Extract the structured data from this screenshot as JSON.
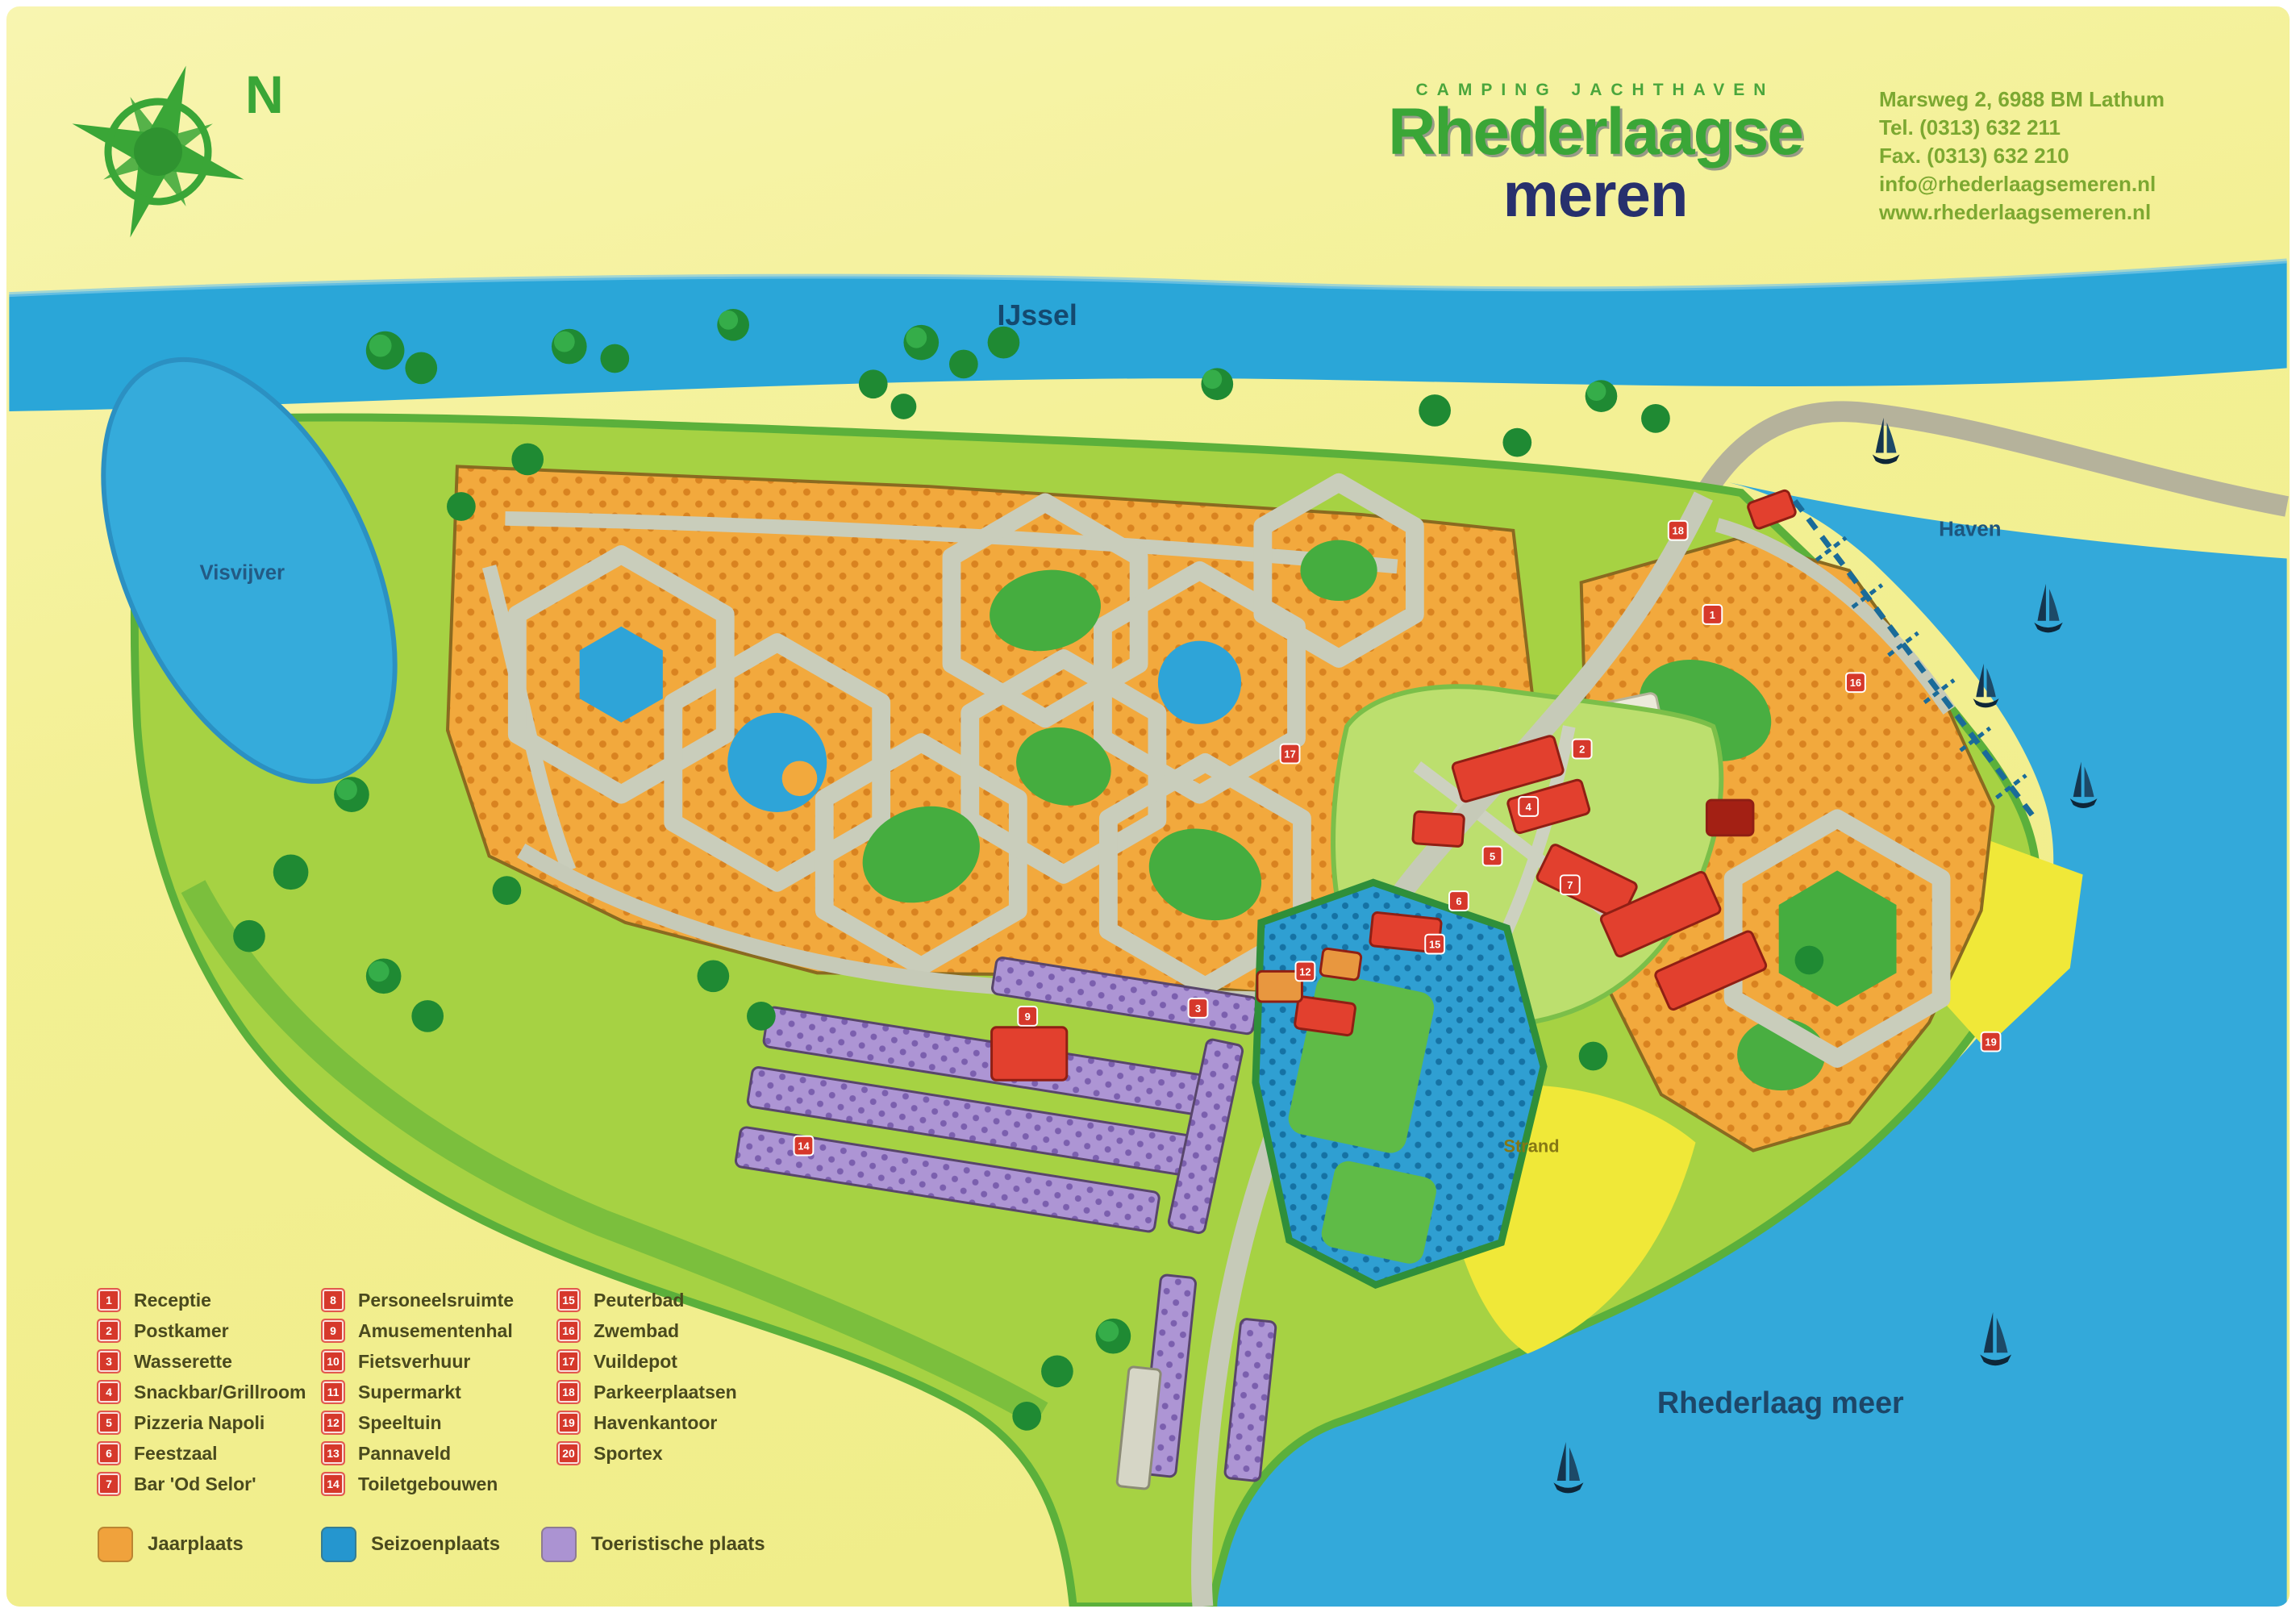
{
  "header": {
    "tagline": "CAMPING JACHTHAVEN",
    "title_line1": "Rhederlaagse",
    "title_line2": "meren",
    "compass_label": "N",
    "contact": {
      "address": "Marsweg 2, 6988 BM Lathum",
      "tel": "Tel.  (0313) 632 211",
      "fax": "Fax. (0313) 632 210",
      "email": "info@rhederlaagsemeren.nl",
      "website": "www.rhederlaagsemeren.nl"
    }
  },
  "map": {
    "labels": {
      "river": "IJssel",
      "pond": "Visvijver",
      "harbor": "Haven",
      "beach": "Strand",
      "lake": "Rhederlaag meer"
    },
    "markers": [
      {
        "num": "18"
      },
      {
        "num": "1"
      },
      {
        "num": "2"
      },
      {
        "num": "4"
      },
      {
        "num": "5"
      },
      {
        "num": "6"
      },
      {
        "num": "7"
      },
      {
        "num": "15"
      },
      {
        "num": "16"
      },
      {
        "num": "17"
      },
      {
        "num": "3"
      },
      {
        "num": "14"
      },
      {
        "num": "9"
      },
      {
        "num": "19"
      },
      {
        "num": "12"
      }
    ]
  },
  "legend": {
    "facilities": [
      {
        "num": "1",
        "label": "Receptie"
      },
      {
        "num": "2",
        "label": "Postkamer"
      },
      {
        "num": "3",
        "label": "Wasserette"
      },
      {
        "num": "4",
        "label": "Snackbar/Grillroom"
      },
      {
        "num": "5",
        "label": "Pizzeria Napoli"
      },
      {
        "num": "6",
        "label": "Feestzaal"
      },
      {
        "num": "7",
        "label": "Bar 'Od Selor'"
      },
      {
        "num": "8",
        "label": "Personeelsruimte"
      },
      {
        "num": "9",
        "label": "Amusementenhal"
      },
      {
        "num": "10",
        "label": "Fietsverhuur"
      },
      {
        "num": "11",
        "label": "Supermarkt"
      },
      {
        "num": "12",
        "label": "Speeltuin"
      },
      {
        "num": "13",
        "label": "Pannaveld"
      },
      {
        "num": "14",
        "label": "Toiletgebouwen"
      },
      {
        "num": "15",
        "label": "Peuterbad"
      },
      {
        "num": "16",
        "label": "Zwembad"
      },
      {
        "num": "17",
        "label": "Vuildepot"
      },
      {
        "num": "18",
        "label": "Parkeerplaatsen"
      },
      {
        "num": "19",
        "label": "Havenkantoor"
      },
      {
        "num": "20",
        "label": "Sportex"
      }
    ],
    "area_types": [
      {
        "label": "Jaarplaats",
        "color": "#f0a23c"
      },
      {
        "label": "Seizoenplaats",
        "color": "#2596cf"
      },
      {
        "label": "Toeristische plaats",
        "color": "#ab93d2"
      }
    ]
  },
  "colors": {
    "water": "#2fa8d9",
    "land": "#a6d243",
    "jaarplaats": "#f2a93d",
    "seizoenplaats": "#2f9fd2",
    "toeristische_plaats": "#ab93d2",
    "building_red": "#e2402e",
    "beach_yellow": "#f0e838",
    "title_green": "#3aa637",
    "title_navy": "#27306d"
  }
}
